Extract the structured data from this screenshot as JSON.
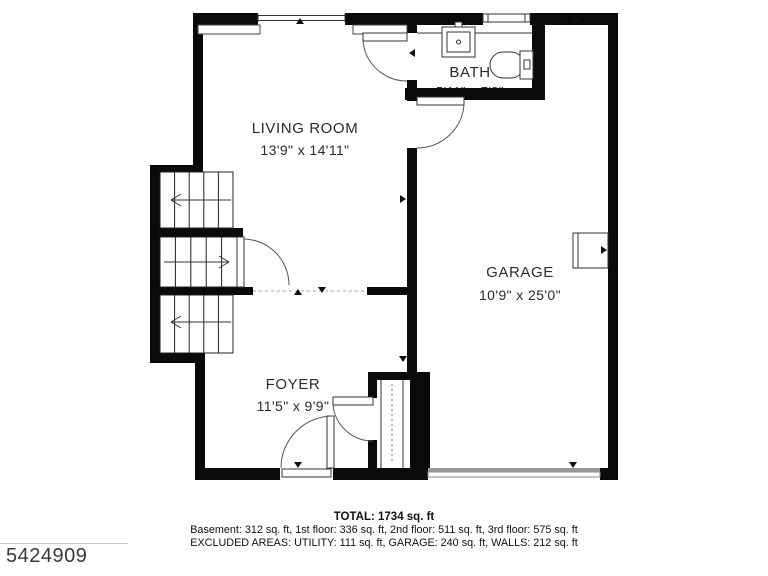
{
  "plan": {
    "rooms": [
      {
        "name": "LIVING ROOM",
        "dims": "13'9\" x 14'11\""
      },
      {
        "name": "BATH",
        "dims": "5'11\" x 7'8\""
      },
      {
        "name": "GARAGE",
        "dims": "10'9\" x 25'0\""
      },
      {
        "name": "FOYER",
        "dims": "11'5\" x 9'9\""
      }
    ]
  },
  "summary": {
    "total": "TOTAL: 1734 sq. ft",
    "floors": "Basement: 312 sq. ft, 1st floor: 336 sq. ft, 2nd floor: 511 sq. ft, 3rd floor: 575 sq. ft",
    "excluded": "EXCLUDED AREAS: UTILITY: 111 sq. ft, GARAGE: 240 sq. ft, WALLS: 212 sq. ft"
  },
  "watermark": {
    "listing_id": "5424909"
  },
  "colors": {
    "wall": "#0a0a0a",
    "line": "#333333",
    "dashed": "#aaaaaa",
    "text": "#2b2b2b"
  }
}
